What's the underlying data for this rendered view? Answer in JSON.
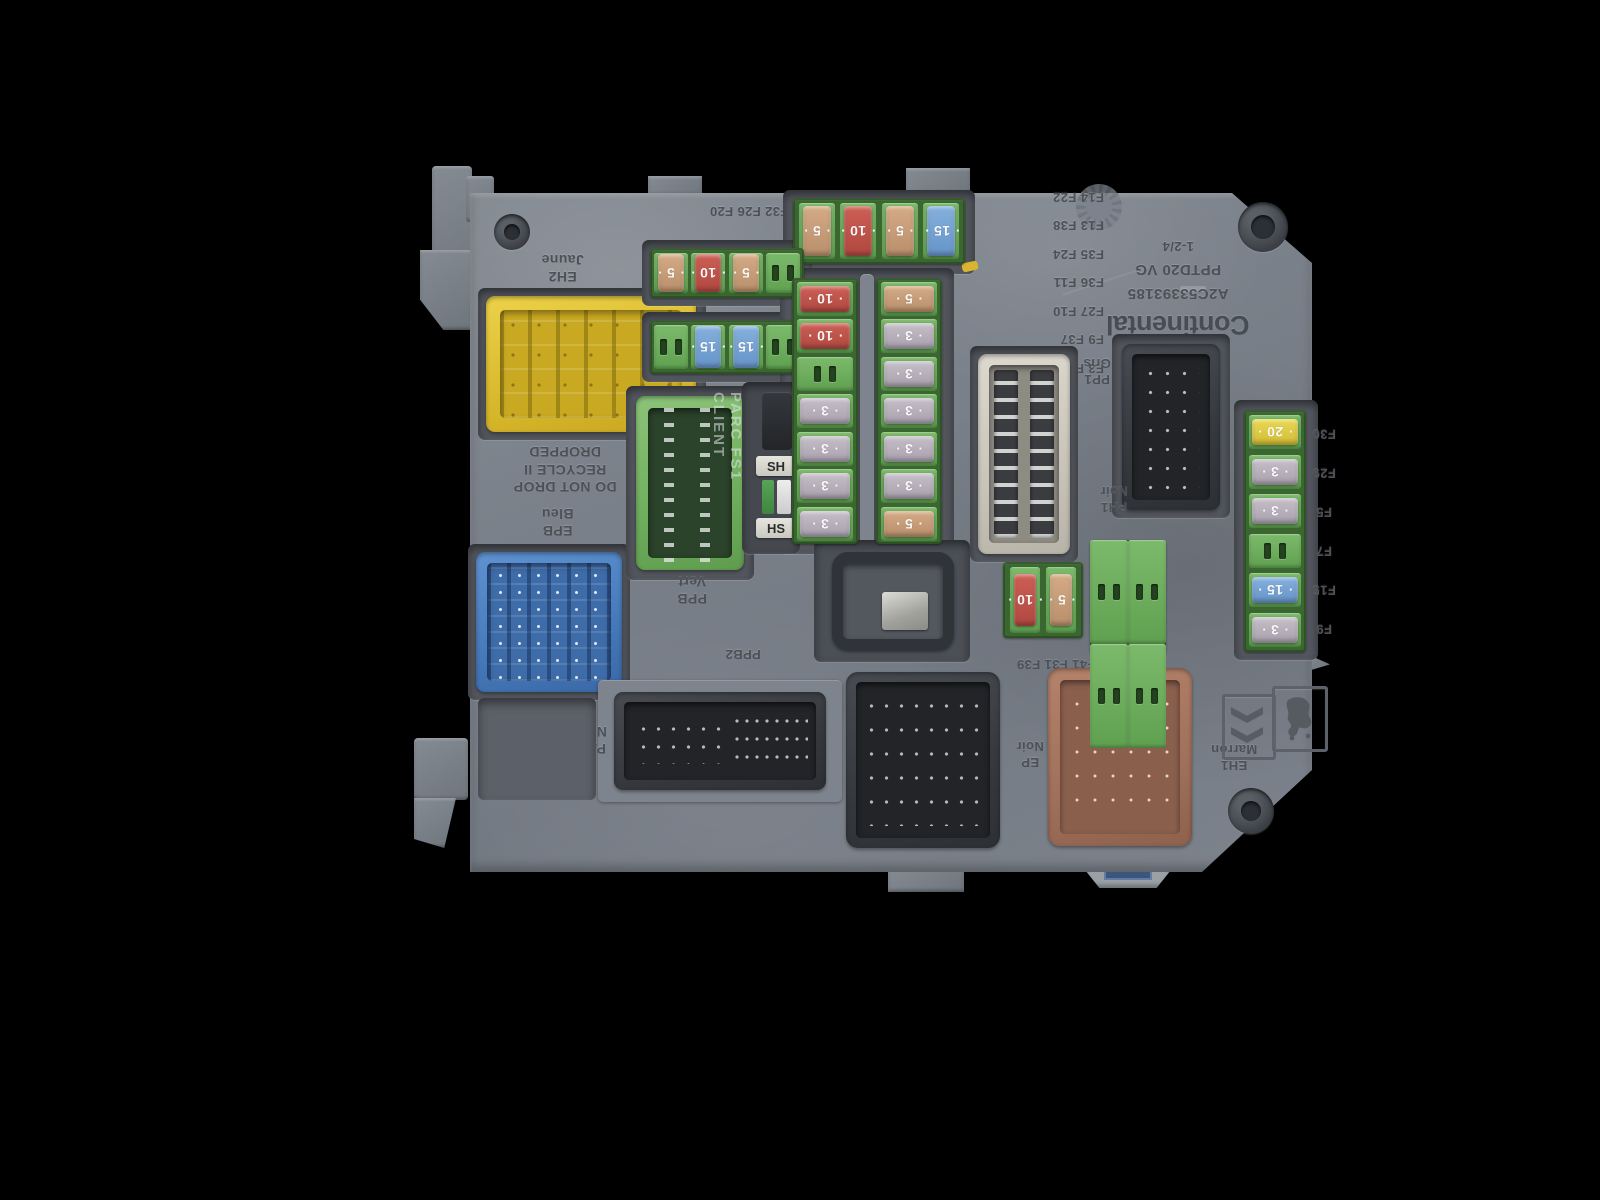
{
  "device": {
    "brand": "Continental",
    "part_number": "A2C53393185",
    "model_code": "PPTD20 VG",
    "index_code": "1-2/4"
  },
  "warning": {
    "lines": [
      "DO NOT DROP",
      "RECYCLE II",
      "DROPPED"
    ]
  },
  "switch": {
    "vertical_text": "PARC FS1 CLIENT",
    "tab_top": "SH",
    "tab_bottom": "HS"
  },
  "connectors": [
    {
      "code": "EH2",
      "color_name": "Jaune",
      "body_color": "#e3c531"
    },
    {
      "code": "EPB",
      "color_name": "Bleu",
      "body_color": "#4d83c4"
    },
    {
      "code": "PPB",
      "color_name": "Vert",
      "body_color": "#7cb96a"
    },
    {
      "code": "PP1",
      "color_name": "Gris",
      "body_color": "#d7d3c8"
    },
    {
      "code": "PH1",
      "color_name": "Noir",
      "body_color": "#33363b"
    },
    {
      "code": "PAV",
      "color_name": "Noir",
      "body_color": "#43464c"
    },
    {
      "code": "EP",
      "color_name": "Noir",
      "body_color": "#3f4247"
    },
    {
      "code": "EH1",
      "color_name": "Marron",
      "body_color": "#aa7860"
    }
  ],
  "molded_labels": {
    "top_block": [
      "F18 F34 F28A F46",
      "F19 F32 F26 F20"
    ],
    "grid_rows": [
      "F3 F4",
      "F9 F37",
      "F27 F10",
      "F36 F11",
      "F35 F24",
      "F13 F38",
      "F14 F22"
    ],
    "bottom_line": "F2 F41 F31 F39",
    "right_column_top_to_bottom": [
      "F30",
      "F29",
      "F5",
      "F7",
      "F15",
      "F9"
    ],
    "ppb2": "PPB2"
  },
  "fuse_colors": {
    "3": "#b7b0ba",
    "5": "#c9a07c",
    "10": "#c0504a",
    "15": "#79a6d6",
    "20": "#e2cf49"
  },
  "fuse_groups": {
    "top_row": [
      5,
      10,
      5,
      15
    ],
    "left_row_1": [
      5,
      10,
      5,
      null
    ],
    "left_row_2": [
      null,
      15,
      15,
      null
    ],
    "col_a": [
      10,
      10,
      null,
      3,
      3,
      3,
      3
    ],
    "col_b": [
      5,
      3,
      3,
      3,
      3,
      3,
      5
    ],
    "right_col": [
      20,
      3,
      3,
      null,
      15,
      3
    ],
    "small_pair": [
      10,
      5
    ],
    "empty_quad": [
      null,
      null,
      null,
      null
    ]
  },
  "logos": {
    "left": "citroen-chevrons",
    "right": "peugeot-lion"
  }
}
